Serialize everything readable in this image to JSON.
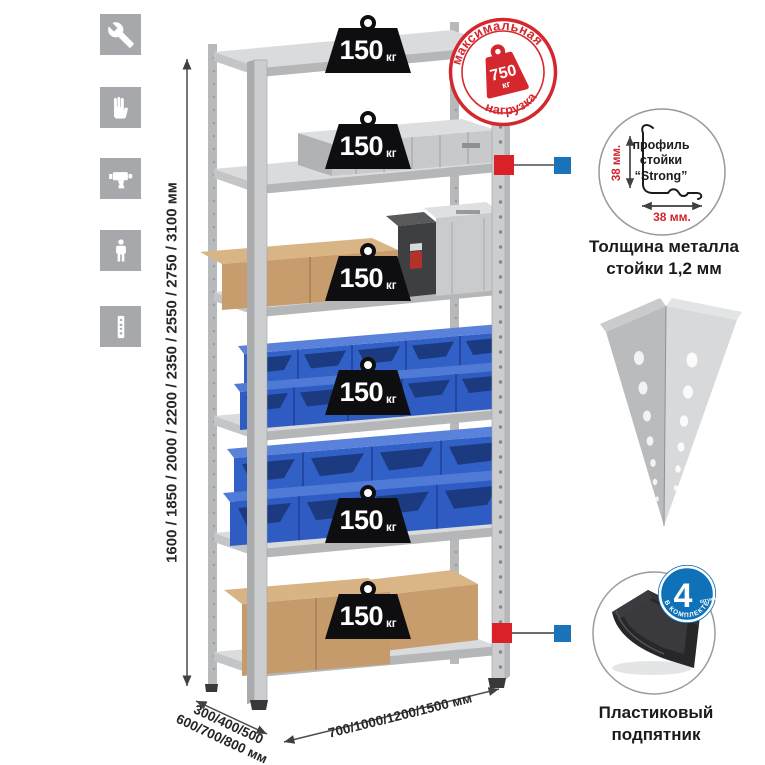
{
  "page_type": "shelving-rack-product-infographic",
  "colors": {
    "accent_red": "#d5272e",
    "accent_blue": "#1b74ba",
    "icon_gray": "#a6a8ab",
    "metal_gray": "#cbcdcf",
    "bin_blue": "#2e5cc2",
    "cardboard": "#c59b6c",
    "badge_black": "#0e0e10"
  },
  "left_icons": [
    {
      "name": "wrench-icon"
    },
    {
      "name": "gloves-icon"
    },
    {
      "name": "drill-icon"
    },
    {
      "name": "person-icon"
    },
    {
      "name": "rack-post-icon"
    }
  ],
  "height_dimension": "1600 / 1850 / 2000 / 2200 / 2350 / 2550 / 2750 / 3100 мм",
  "depth_dimension": {
    "line1": "300/400/500",
    "line2": "600/700/800 мм"
  },
  "width_dimension": "700/1000/1200/1500 мм",
  "shelf_badges": [
    {
      "value": "150",
      "unit": "кг"
    },
    {
      "value": "150",
      "unit": "кг"
    },
    {
      "value": "150",
      "unit": "кг"
    },
    {
      "value": "150",
      "unit": "кг"
    },
    {
      "value": "150",
      "unit": "кг"
    },
    {
      "value": "150",
      "unit": "кг"
    }
  ],
  "max_load_stamp": {
    "arc_top": "максимальная",
    "arc_bottom": "нагрузка",
    "value": "750",
    "unit": "кг"
  },
  "profile_callout": {
    "line1": "профиль",
    "line2": "стойки",
    "line3": "“Strong”",
    "vertical_dim": "38 мм.",
    "horizontal_dim": "38 мм.",
    "caption1": "Толщина металла",
    "caption2": "стойки 1,2 мм"
  },
  "foot_callout": {
    "count": "4",
    "count_note": "штуки",
    "arc_text": "в комплекте",
    "caption1": "Пластиковый",
    "caption2": "подпятник"
  }
}
